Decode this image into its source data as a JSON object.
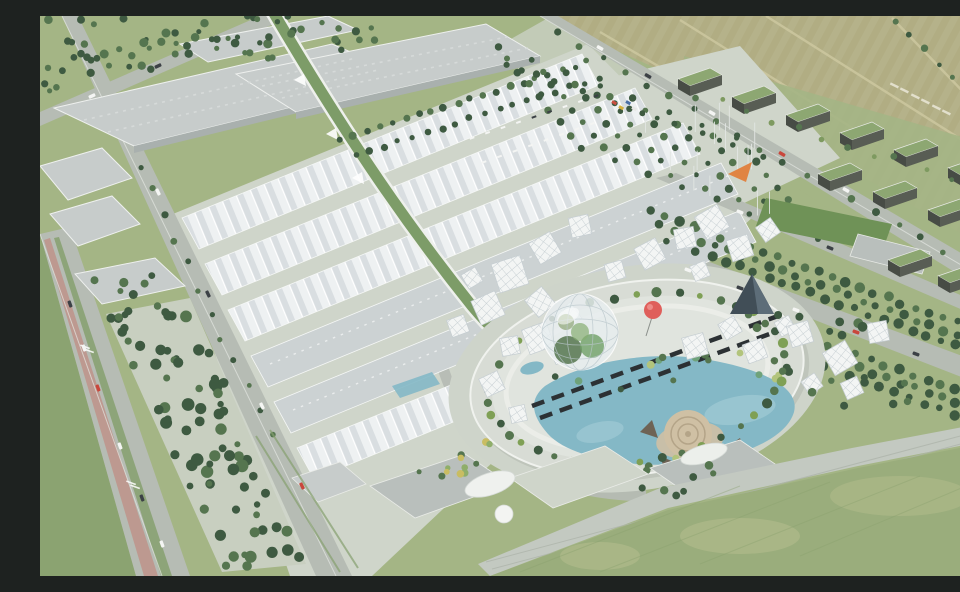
{
  "scene": {
    "description": "Aerial 3D rendering of an exhibition-center masterplan: rows of white sawtooth exhibition halls and gray logistics warehouses, a central elliptical plaza with a glass geodesic dome, a red spherical balloon, a turquoise lagoon and circular amphitheater, tree-lined boulevards, parking groves with planted tree rows, dark perforated residential blocks with green roofs, a sports field, a dark glass pyramid pavilion, a diagonal green pedestrian spine, and surrounding meadows and farm fields.",
    "type_label": "architectural aerial rendering"
  },
  "elements": [
    "exhibition-halls",
    "logistics-warehouses",
    "central-elliptical-plaza",
    "geodesic-dome",
    "red-balloon",
    "lagoon",
    "amphitheater",
    "boardwalk",
    "tree-lined-boulevard",
    "parking-grove",
    "residential-blocks",
    "sports-field",
    "glass-pyramid",
    "green-spine",
    "perimeter-road",
    "entrance-plaza",
    "flag-poles",
    "meadow",
    "farm-fields",
    "canopy-pavilions",
    "plinth-buildings",
    "terrace-steps"
  ],
  "palette": {
    "grass": "#a4b585",
    "grassDark": "#8ba371",
    "meadow": "#9aad7c",
    "meadowLight": "#bcc192",
    "field": "#b5b28a",
    "fieldTexA": "#aca97d",
    "fieldPath": "#cdc8a0",
    "road": "#b6bcb4",
    "roadEdge": "#e4e7e2",
    "pavement": "#cfd5ca",
    "esplanade": "#c8cfc0",
    "apron": "#ced4ca",
    "rim": "#d8dcd5",
    "plazaFill": "#e0e4de",
    "warehouse": "#c7cccb",
    "warehouseShade": "#a9b0ae",
    "hallLight": "#eef1f2",
    "hallShade": "#d9dee1",
    "hallFlat": "#ccd2d3",
    "spineGreen": "#7d9c68",
    "treeDark": "#3e5a41",
    "treeMid": "#55754f",
    "treeLight": "#7e9a60",
    "water": "#84b8c6",
    "waterLight": "#a9d0d9",
    "domeGlass": "#e8eef0",
    "domeLine": "#b9c6cb",
    "balloonRed": "#df5f5b",
    "balloonEdge": "#c14a48",
    "sand": "#cfc0a4",
    "sandDark": "#b4a488",
    "rock": "#6e6355",
    "resWall": "#585d54",
    "resWallDark": "#474c45",
    "resRoof": "#8da772",
    "pitch": "#6f9257",
    "depot": "#b9bfbc",
    "pyramid": "#414e57",
    "pyramidLight": "#5d6d78",
    "canopy": "#f3f5f4",
    "canopyLine": "#c6ced2",
    "pole": "#e2e6e3",
    "carWhite": "#f4f5f3",
    "carRed": "#c9473c",
    "carDark": "#3c4146",
    "orange": "#e08443",
    "bikeLane": "#c08a80",
    "median": "#86a06f",
    "berm": "#c3c9c1",
    "boardwalk": "#2c3134"
  }
}
